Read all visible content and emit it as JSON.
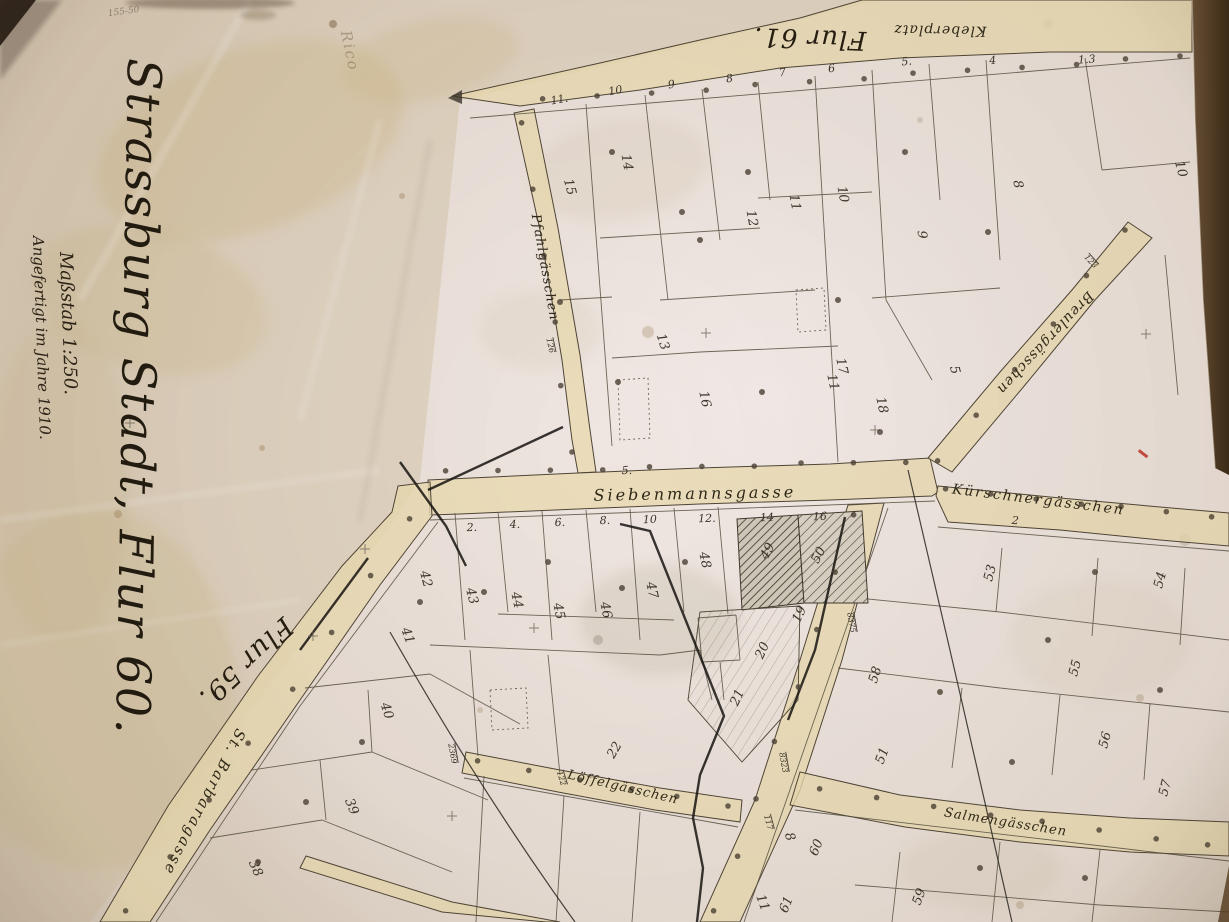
{
  "colors": {
    "paper": "#dccfc0",
    "paper_pink": "#f3ebe9",
    "paper_tan": "#d3c4a8",
    "street_fill": "#e8d9b0",
    "ink": "#3c352a",
    "margin_brown": "#5a4227",
    "accent_red": "#c23b2e"
  },
  "title_block": {
    "title": {
      "text": "Strassburg Stadt, Flur 60.",
      "x": 128,
      "y": 58,
      "rot": 91,
      "size": 47
    },
    "scale": {
      "text": "Maßstab 1:250.",
      "x": 60,
      "y": 252,
      "rot": 88,
      "size": 18
    },
    "date": {
      "text": "Angefertigt im Jahre 1910.",
      "x": 33,
      "y": 236,
      "rot": 88,
      "size": 15
    }
  },
  "flur_labels": [
    {
      "text": "Flur 61.",
      "x": 810,
      "y": 30,
      "rot": 182,
      "size": 26
    },
    {
      "text": "Flur 59.",
      "x": 240,
      "y": 656,
      "rot": 137,
      "size": 27
    }
  ],
  "street_labels": [
    {
      "id": "kleberplatz",
      "text": "Kleberplatz",
      "x": 940,
      "y": 26,
      "rot": 181,
      "size": 14,
      "ls": 1
    },
    {
      "id": "pfahlgaesschen",
      "text": "Pfahlgässchen",
      "x": 541,
      "y": 268,
      "rot": 80,
      "size": 13,
      "ls": 1
    },
    {
      "id": "siebenmannsgasse",
      "text": "Siebenmannsgasse",
      "x": 695,
      "y": 499,
      "rot": -1,
      "size": 16,
      "ls": 3
    },
    {
      "id": "kuerschnergaesschen",
      "text": "Kürschnergässchen",
      "x": 1038,
      "y": 504,
      "rot": 7,
      "size": 14,
      "ls": 2
    },
    {
      "id": "breulergaesschen",
      "text": "Breulergässchen",
      "x": 1042,
      "y": 340,
      "rot": 133,
      "size": 14,
      "ls": 1
    },
    {
      "id": "st-barbaragasse",
      "text": "St. Barbaragasse",
      "x": 200,
      "y": 800,
      "rot": 117,
      "size": 15,
      "ls": 2
    },
    {
      "id": "loeffelgaesschen",
      "text": "Löffelgässchen",
      "x": 622,
      "y": 791,
      "rot": 13,
      "size": 13,
      "ls": 1
    },
    {
      "id": "salmengaesschen",
      "text": "Salmengässchen",
      "x": 1005,
      "y": 826,
      "rot": 9,
      "size": 13,
      "ls": 1
    }
  ],
  "parcel_numbers": [
    {
      "t": "15",
      "x": 566,
      "y": 188,
      "r": 75
    },
    {
      "t": "14",
      "x": 623,
      "y": 163,
      "r": 80
    },
    {
      "t": "12",
      "x": 748,
      "y": 219,
      "r": 80
    },
    {
      "t": "11",
      "x": 791,
      "y": 203,
      "r": 80
    },
    {
      "t": "10",
      "x": 839,
      "y": 195,
      "r": 80
    },
    {
      "t": "13",
      "x": 659,
      "y": 343,
      "r": 72
    },
    {
      "t": "16",
      "x": 701,
      "y": 400,
      "r": 78
    },
    {
      "t": "17",
      "x": 838,
      "y": 367,
      "r": 78
    },
    {
      "t": "11",
      "x": 829,
      "y": 383,
      "r": 78
    },
    {
      "t": "18",
      "x": 878,
      "y": 406,
      "r": 78
    },
    {
      "t": "5",
      "x": 951,
      "y": 371,
      "r": 75
    },
    {
      "t": "9",
      "x": 918,
      "y": 235,
      "r": 85
    },
    {
      "t": "8",
      "x": 1014,
      "y": 185,
      "r": 80
    },
    {
      "t": "10",
      "x": 1177,
      "y": 170,
      "r": 75
    },
    {
      "t": "2",
      "x": 1202,
      "y": 243,
      "r": 70
    },
    {
      "t": "42",
      "x": 422,
      "y": 580,
      "r": 75
    },
    {
      "t": "43",
      "x": 468,
      "y": 597,
      "r": 75
    },
    {
      "t": "44",
      "x": 513,
      "y": 601,
      "r": 78
    },
    {
      "t": "45",
      "x": 555,
      "y": 612,
      "r": 78
    },
    {
      "t": "46",
      "x": 602,
      "y": 611,
      "r": 78
    },
    {
      "t": "47",
      "x": 648,
      "y": 591,
      "r": 78
    },
    {
      "t": "48",
      "x": 701,
      "y": 561,
      "r": 78
    },
    {
      "t": "41",
      "x": 404,
      "y": 637,
      "r": 70
    },
    {
      "t": "40",
      "x": 383,
      "y": 712,
      "r": 72
    },
    {
      "t": "39",
      "x": 348,
      "y": 808,
      "r": 68
    },
    {
      "t": "38",
      "x": 252,
      "y": 870,
      "r": 66
    },
    {
      "t": "49",
      "x": 771,
      "y": 553,
      "r": -62
    },
    {
      "t": "50",
      "x": 822,
      "y": 557,
      "r": -62
    },
    {
      "t": "19",
      "x": 803,
      "y": 616,
      "r": -64
    },
    {
      "t": "20",
      "x": 766,
      "y": 652,
      "r": -66
    },
    {
      "t": "21",
      "x": 741,
      "y": 699,
      "r": -66
    },
    {
      "t": "22",
      "x": 618,
      "y": 752,
      "r": -60
    },
    {
      "t": "60",
      "x": 820,
      "y": 849,
      "r": -68
    },
    {
      "t": "61",
      "x": 790,
      "y": 906,
      "r": -68
    },
    {
      "t": "51",
      "x": 886,
      "y": 757,
      "r": -70
    },
    {
      "t": "58",
      "x": 879,
      "y": 676,
      "r": -72
    },
    {
      "t": "53",
      "x": 994,
      "y": 574,
      "r": -75
    },
    {
      "t": "54",
      "x": 1164,
      "y": 581,
      "r": -75
    },
    {
      "t": "55",
      "x": 1079,
      "y": 669,
      "r": -75
    },
    {
      "t": "56",
      "x": 1109,
      "y": 741,
      "r": -75
    },
    {
      "t": "57",
      "x": 1169,
      "y": 789,
      "r": -75
    },
    {
      "t": "59",
      "x": 923,
      "y": 898,
      "r": -70
    },
    {
      "t": "8",
      "x": 786,
      "y": 838,
      "r": 72
    },
    {
      "t": "11",
      "x": 759,
      "y": 904,
      "r": 70
    }
  ],
  "house_numbers": [
    {
      "t": "11.",
      "x": 560,
      "y": 103,
      "r": -10
    },
    {
      "t": "10",
      "x": 616,
      "y": 94,
      "r": -10
    },
    {
      "t": "9",
      "x": 672,
      "y": 88,
      "r": -9
    },
    {
      "t": "8",
      "x": 730,
      "y": 82,
      "r": -8
    },
    {
      "t": "7",
      "x": 783,
      "y": 76,
      "r": -8
    },
    {
      "t": "6",
      "x": 832,
      "y": 72,
      "r": -7
    },
    {
      "t": "5.",
      "x": 907,
      "y": 65,
      "r": -6
    },
    {
      "t": "4",
      "x": 993,
      "y": 64,
      "r": -5
    },
    {
      "t": "1.3",
      "x": 1087,
      "y": 63,
      "r": -4
    },
    {
      "t": "2.",
      "x": 472,
      "y": 531,
      "r": -2
    },
    {
      "t": "4.",
      "x": 515,
      "y": 528,
      "r": -2
    },
    {
      "t": "6.",
      "x": 560,
      "y": 526,
      "r": -2
    },
    {
      "t": "8.",
      "x": 605,
      "y": 524,
      "r": -2
    },
    {
      "t": "10",
      "x": 650,
      "y": 523,
      "r": -2
    },
    {
      "t": "12.",
      "x": 707,
      "y": 522,
      "r": -2
    },
    {
      "t": "14",
      "x": 767,
      "y": 521,
      "r": -2
    },
    {
      "t": "16",
      "x": 820,
      "y": 520,
      "r": -2
    },
    {
      "t": "5.",
      "x": 627,
      "y": 474,
      "r": -2
    },
    {
      "t": "2",
      "x": 1015,
      "y": 524,
      "r": 5
    }
  ],
  "survey_marks": [
    {
      "t": "123",
      "x": 1089,
      "y": 263,
      "r": 48
    },
    {
      "t": "126",
      "x": 548,
      "y": 346,
      "r": 78
    },
    {
      "t": "8375",
      "x": 849,
      "y": 623,
      "r": 80
    },
    {
      "t": "8323",
      "x": 781,
      "y": 763,
      "r": 80
    },
    {
      "t": "117",
      "x": 766,
      "y": 823,
      "r": 75
    },
    {
      "t": "2369",
      "x": 450,
      "y": 754,
      "r": 80
    },
    {
      "t": "122",
      "x": 559,
      "y": 779,
      "r": 73
    }
  ],
  "annotations": [
    {
      "id": "stamp",
      "text": "Rico",
      "x": 345,
      "y": 52,
      "rot": 78,
      "size": 15,
      "cls": "t-stamp"
    },
    {
      "id": "pencil-note",
      "text": "155-50",
      "x": 124,
      "y": 14,
      "rot": -8,
      "size": 9,
      "cls": "t-pencil"
    }
  ]
}
